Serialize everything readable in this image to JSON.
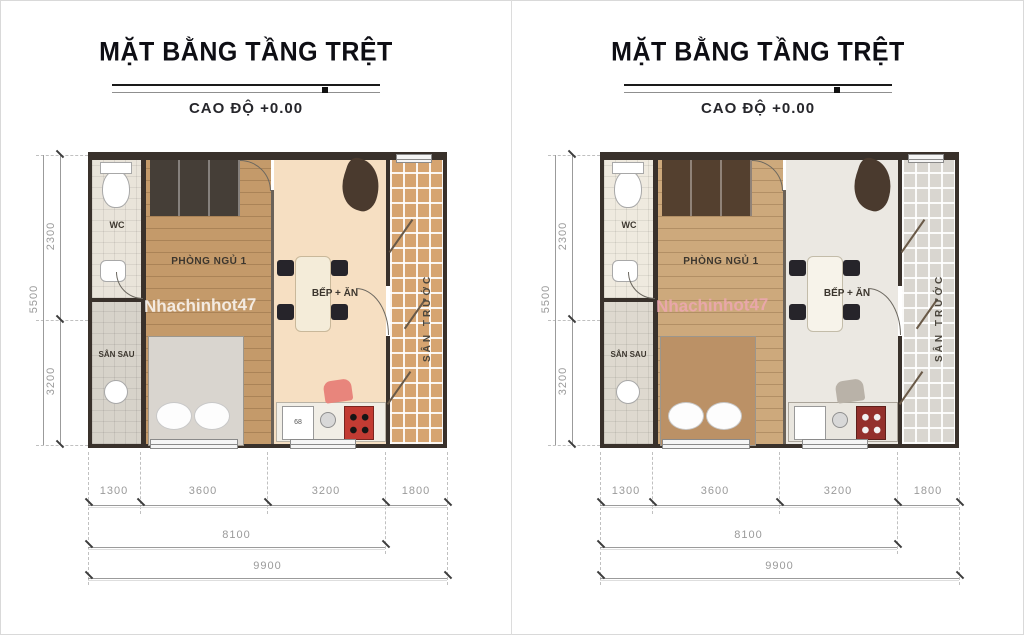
{
  "page": {
    "background": "#ffffff",
    "frame_color": "#d9d9d9"
  },
  "panels": [
    {
      "title": "MẶT BẰNG TẦNG TRỆT",
      "subtitle": "CAO ĐỘ +0.00",
      "rooms": {
        "wc": "WC",
        "back_yard": "SÂN SAU",
        "bedroom": "PHÒNG NGỦ 1",
        "kitchen": "BẾP + ĂN",
        "front_yard": "SÂN TRƯỚC"
      },
      "watermark": {
        "text": "Nhachinhot47",
        "color": "#ffffff"
      },
      "fixtures": {
        "appliance_label": "68"
      },
      "dimensions": {
        "segments": [
          "1300",
          "3600",
          "3200",
          "1800"
        ],
        "subtotal": "8100",
        "total": "9900",
        "vertical_segments": [
          "2300",
          "3200"
        ],
        "vertical_total": "5500"
      },
      "colors": {
        "wall": "#39312b",
        "wc_floor": "#e9e4da",
        "backyard_floor": "#d7d3ca",
        "bedroom_floor": "#c49a6a",
        "wardrobe": "#453e37",
        "bed": "#d9d5cf",
        "kitchen_floor": "#f6dfc2",
        "counter": "#f1eee6",
        "stove": "#c23b33",
        "yard": "#d6a470",
        "accent_chair": "#e8857c"
      }
    },
    {
      "title": "MẶT BẰNG TẦNG TRỆT",
      "subtitle": "CAO ĐỘ +0.00",
      "rooms": {
        "wc": "WC",
        "back_yard": "SÂN SAU",
        "bedroom": "PHÒNG NGỦ 1",
        "kitchen": "BẾP + ĂN",
        "front_yard": "SÂN TRƯỚC"
      },
      "watermark": {
        "text": "Nhachinhot47",
        "color": "#f0a7b6"
      },
      "dimensions": {
        "segments": [
          "1300",
          "3600",
          "3200",
          "1800"
        ],
        "subtotal": "8100",
        "total": "9900",
        "vertical_segments": [
          "2300",
          "3200"
        ],
        "vertical_total": "5500"
      },
      "colors": {
        "wall": "#39312b",
        "wc_floor": "#efeadf",
        "backyard_floor": "#ded9cf",
        "bedroom_floor": "#cda97c",
        "wardrobe": "#54402f",
        "bed": "#bb9166",
        "kitchen_floor": "#ebe8e2",
        "counter": "#e9e6df",
        "stove": "#93302c",
        "yard": "#d9d6d0",
        "accent_chair": "#b9b2a8"
      }
    }
  ]
}
